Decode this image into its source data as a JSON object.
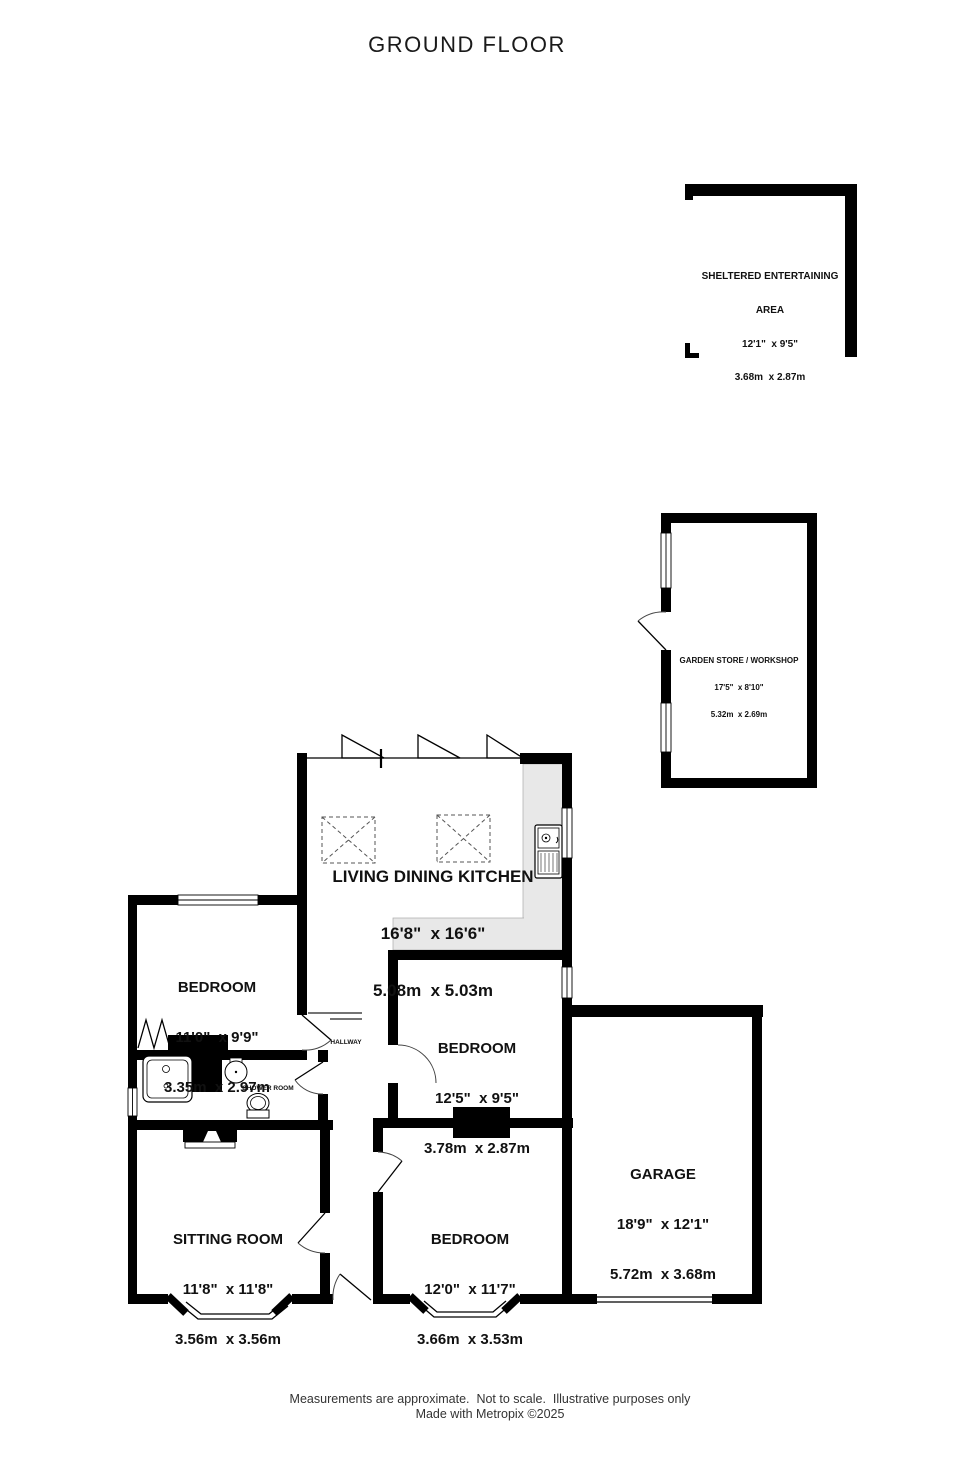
{
  "title": "GROUND FLOOR",
  "rooms": {
    "sheltered_entertaining_area": {
      "line1": "SHELTERED ENTERTAINING",
      "line2": "AREA",
      "imperial": "12'1\"  x 9'5\"",
      "metric": "3.68m  x 2.87m"
    },
    "garden_store_workshop": {
      "name": "GARDEN STORE / WORKSHOP",
      "imperial": "17'5\"  x 8'10\"",
      "metric": "5.32m  x 2.69m"
    },
    "living_dining_kitchen": {
      "name": "LIVING DINING KITCHEN",
      "imperial": "16'8\"  x 16'6\"",
      "metric": "5.08m  x 5.03m"
    },
    "bedroom_left": {
      "name": "BEDROOM",
      "imperial": "11'0\"  x 9'9\"",
      "metric": "3.35m  x 2.97m"
    },
    "bedroom_middle": {
      "name": "BEDROOM",
      "imperial": "12'5\"  x 9'5\"",
      "metric": "3.78m  x 2.87m"
    },
    "bedroom_bottom": {
      "name": "BEDROOM",
      "imperial": "12'0\"  x 11'7\"",
      "metric": "3.66m  x 3.53m"
    },
    "sitting_room": {
      "name": "SITTING ROOM",
      "imperial": "11'8\"  x 11'8\"",
      "metric": "3.56m  x 3.56m"
    },
    "garage": {
      "name": "GARAGE",
      "imperial": "18'9\"  x 12'1\"",
      "metric": "5.72m  x 3.68m"
    },
    "hallway": {
      "name": "HALLWAY"
    },
    "shower_room": {
      "name": "SHOWER ROOM"
    }
  },
  "footer": {
    "line1": "Measurements are approximate.  Not to scale.  Illustrative purposes only",
    "line2": "Made with Metropix ©2025"
  },
  "colors": {
    "wall": "#000000",
    "counter": "#e8e8e8",
    "background": "#ffffff"
  }
}
